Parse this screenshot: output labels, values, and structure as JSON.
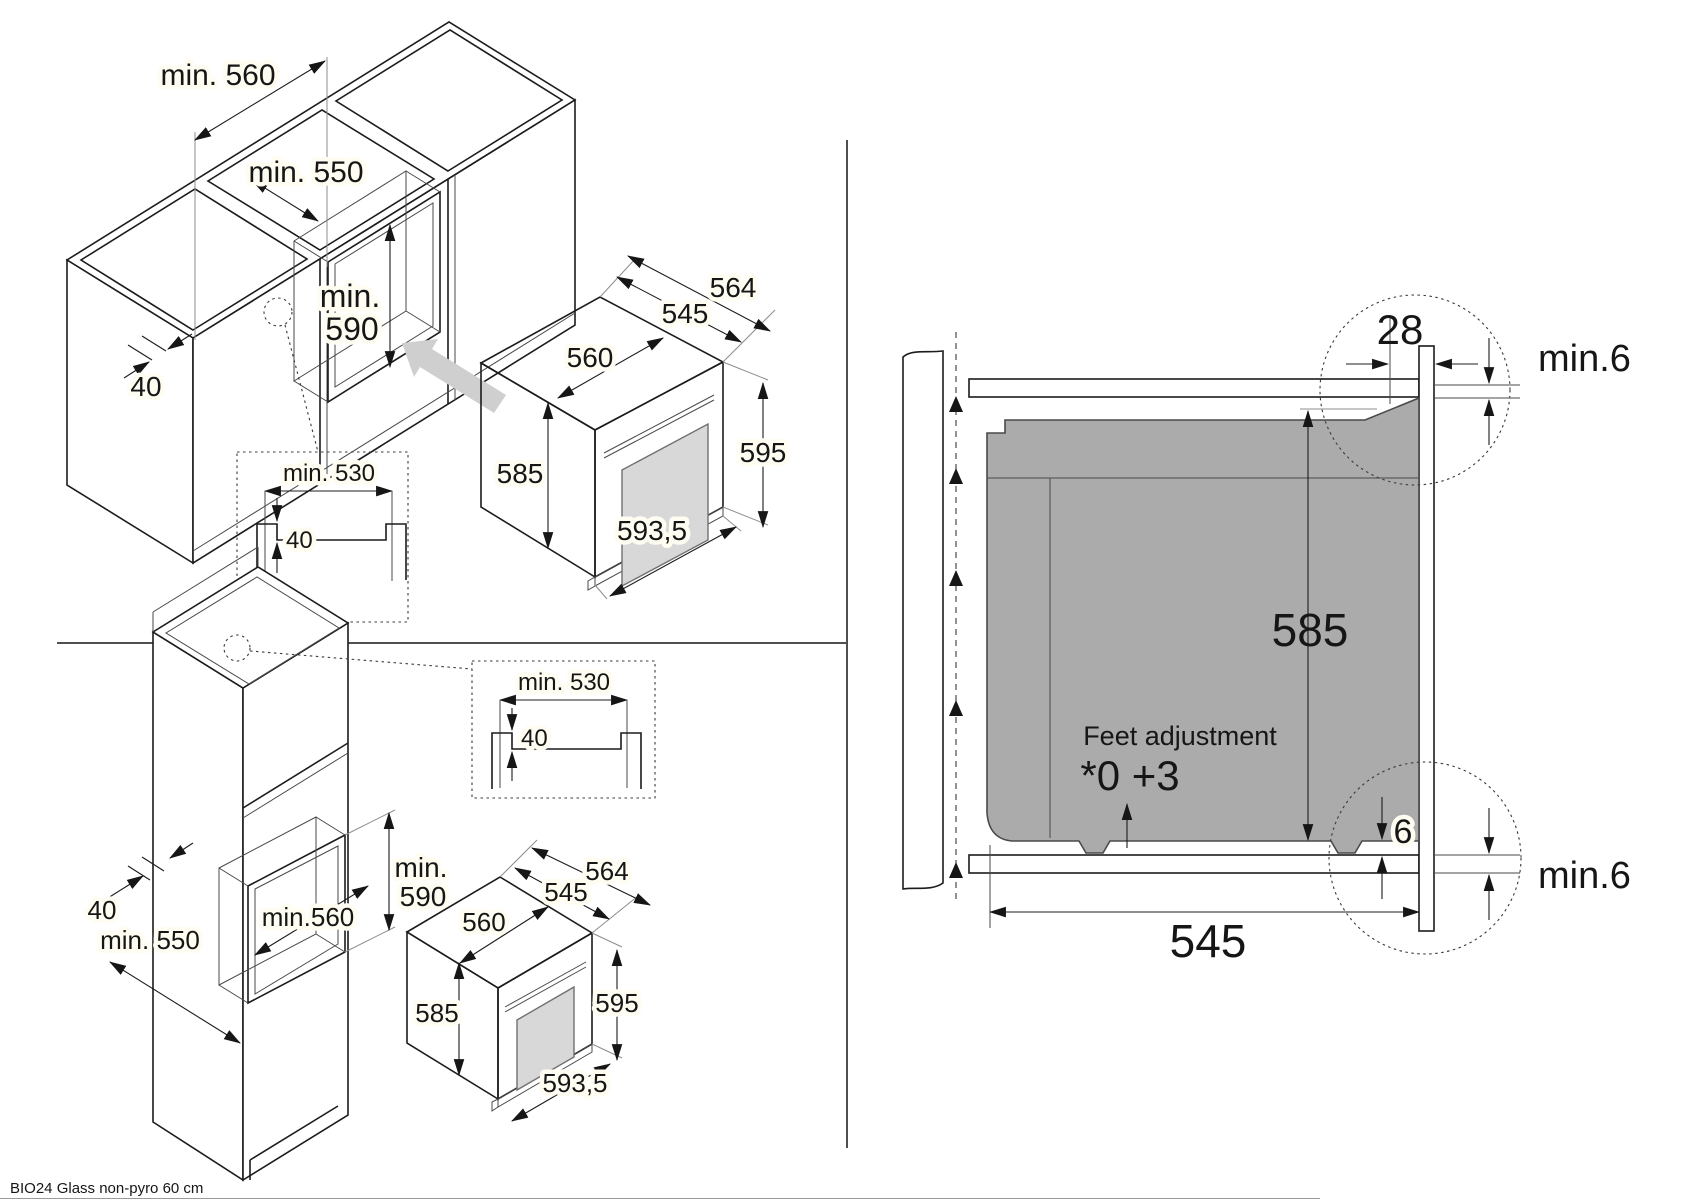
{
  "under_counter": {
    "niche_width": "min. 560",
    "niche_depth": "min. 550",
    "niche_height_l1": "min.",
    "niche_height_l2": "590",
    "front_offset": "40",
    "vent": {
      "width": "min. 530",
      "depth": "40"
    },
    "oven": {
      "width_overall": "564",
      "depth": "545",
      "width_body": "560",
      "height_body": "585",
      "height_front": "595",
      "width_front": "593,5"
    }
  },
  "column": {
    "niche_height_l1": "min.",
    "niche_height_l2": "590",
    "niche_width": "min.560",
    "front_offset": "40",
    "cabinet_depth": "min. 550",
    "vent": {
      "width": "min. 530",
      "depth": "40"
    },
    "oven": {
      "width_overall": "564",
      "depth": "545",
      "width_body": "560",
      "height_body": "585",
      "height_front": "595",
      "width_front": "593,5"
    }
  },
  "section": {
    "frame_offset": "28",
    "top_clearance": "min.6",
    "height": "585",
    "feet_title": "Feet adjustment",
    "feet_range": "*0 +3",
    "bottom_gap": "6",
    "bottom_clearance": "min.6",
    "depth": "545"
  },
  "footer": {
    "model": "BIO24 Glass non-pyro 60 cm"
  }
}
